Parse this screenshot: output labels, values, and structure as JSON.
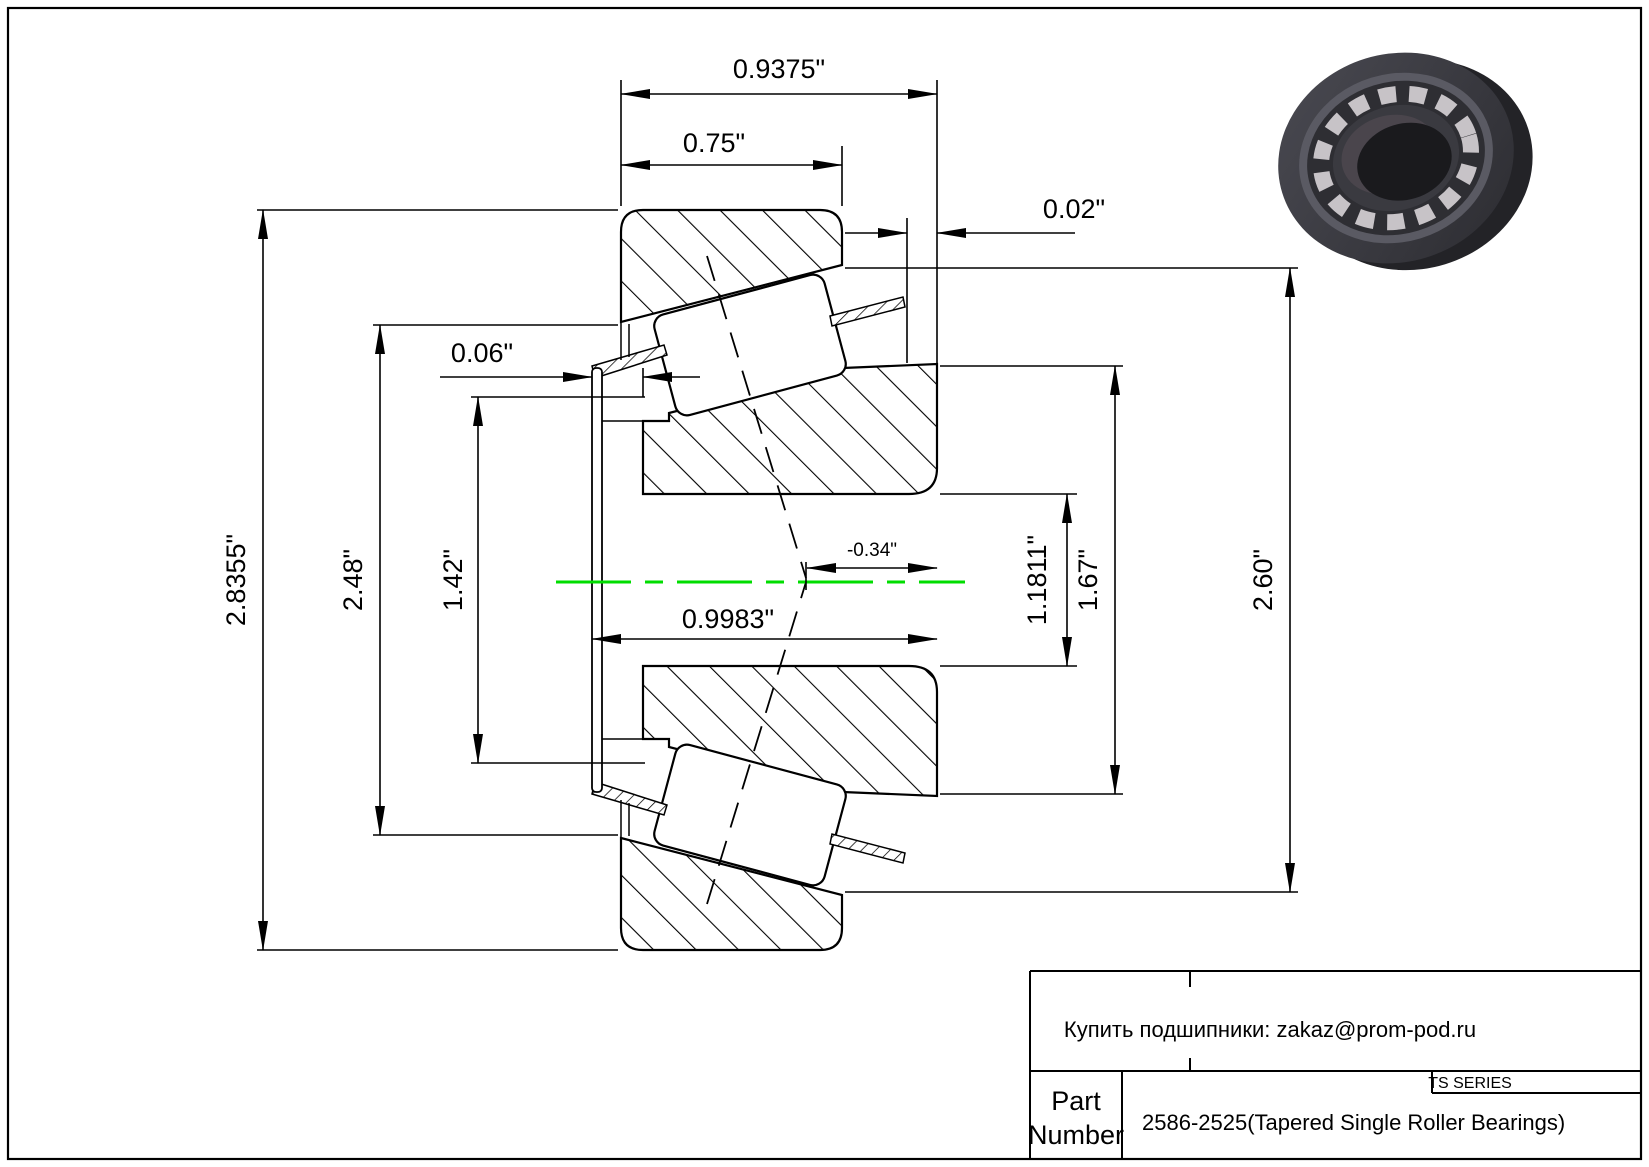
{
  "drawing": {
    "dimensions": {
      "overall_width": "0.9375\"",
      "cup_width": "0.75\"",
      "standout": "0.02\"",
      "cage_protrusion": "0.06\"",
      "cup_od": "2.8355\"",
      "flange_diameter": "2.48\"",
      "cage_diameter": "1.42\"",
      "load_center_offset": "-0.34\"",
      "cone_width": "0.9983\"",
      "bore_diameter": "1.1811\"",
      "rib_diameter": "1.67\"",
      "shoulder_diameter": "2.60\""
    },
    "colors": {
      "centerline_green": "#00dd00",
      "line_black": "#000000"
    }
  },
  "title_block": {
    "vendor_note": "Купить подшипники: zakaz@prom-pod.ru",
    "part_label_line1": "Part",
    "part_label_line2": "Number",
    "part_number": "2586-2525(Tapered Single Roller Bearings)",
    "series": "TS SERIES"
  },
  "bearing_photo": {
    "description": "3d-render-tapered-roller-bearing"
  }
}
